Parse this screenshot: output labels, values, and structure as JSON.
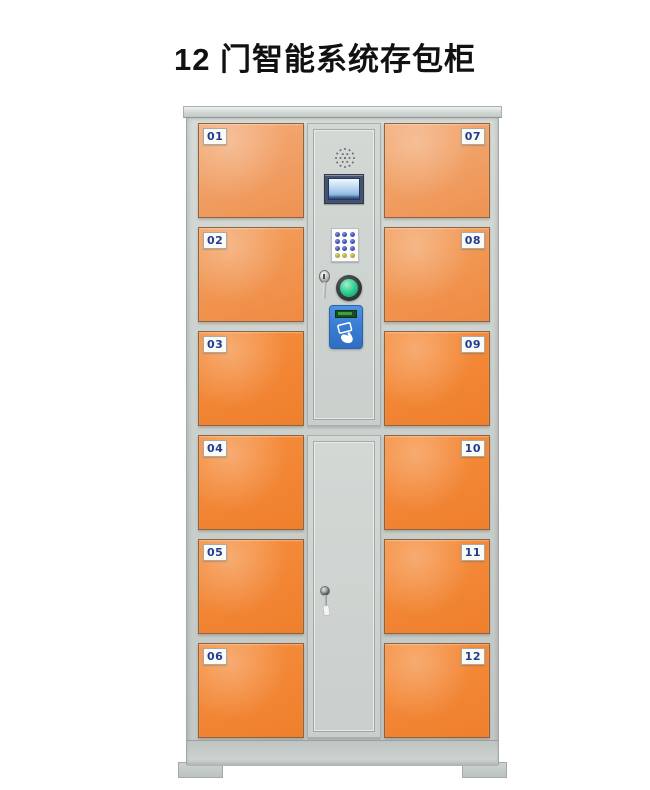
{
  "title": "12 门智能系统存包柜",
  "locker": {
    "left_doors": [
      "01",
      "02",
      "03",
      "04",
      "05",
      "06"
    ],
    "right_doors": [
      "07",
      "08",
      "09",
      "10",
      "11",
      "12"
    ],
    "control_panel": {
      "speaker_icon": "speaker-grill",
      "display_icon": "lcd-screen",
      "keypad_icon": "numeric-keypad",
      "key_icon": "key-in-lock",
      "button_icon": "green-confirm-button",
      "card_reader_icon": "swipe-card-reader"
    },
    "service_door": {
      "keyhole_icon": "keyhole-with-key"
    }
  },
  "theme": {
    "page_bg": "#ffffff",
    "title_color": "#111111",
    "frame_light": "#d6dbd8",
    "frame_mid": "#cbd1ce",
    "door_orange_1": "#f3ab77",
    "door_orange_2": "#f3a05f",
    "door_orange_3": "#f68e3e",
    "door_deep": "#ee7f2d",
    "door_border": "#8a6545",
    "label_bg": "#fafaf7",
    "label_border": "#a9aaa2",
    "label_text": "#223c8f",
    "lcd_frame": "#46536e",
    "lcd_top": "#f0f7fe",
    "lcd_mid": "#aecfee",
    "lcd_deep": "#31507c",
    "keypad_bg": "#fcfcfa",
    "key_blue": "#4152b8",
    "key_yellow": "#b7ab3f",
    "button_ring": "#2f3335",
    "button_green": "#27c98a",
    "reader_blue": "#3b80d6",
    "reader_border": "#2b63aa",
    "reader_display_bg": "#17501a",
    "reader_display_lit": "#4da84d"
  }
}
